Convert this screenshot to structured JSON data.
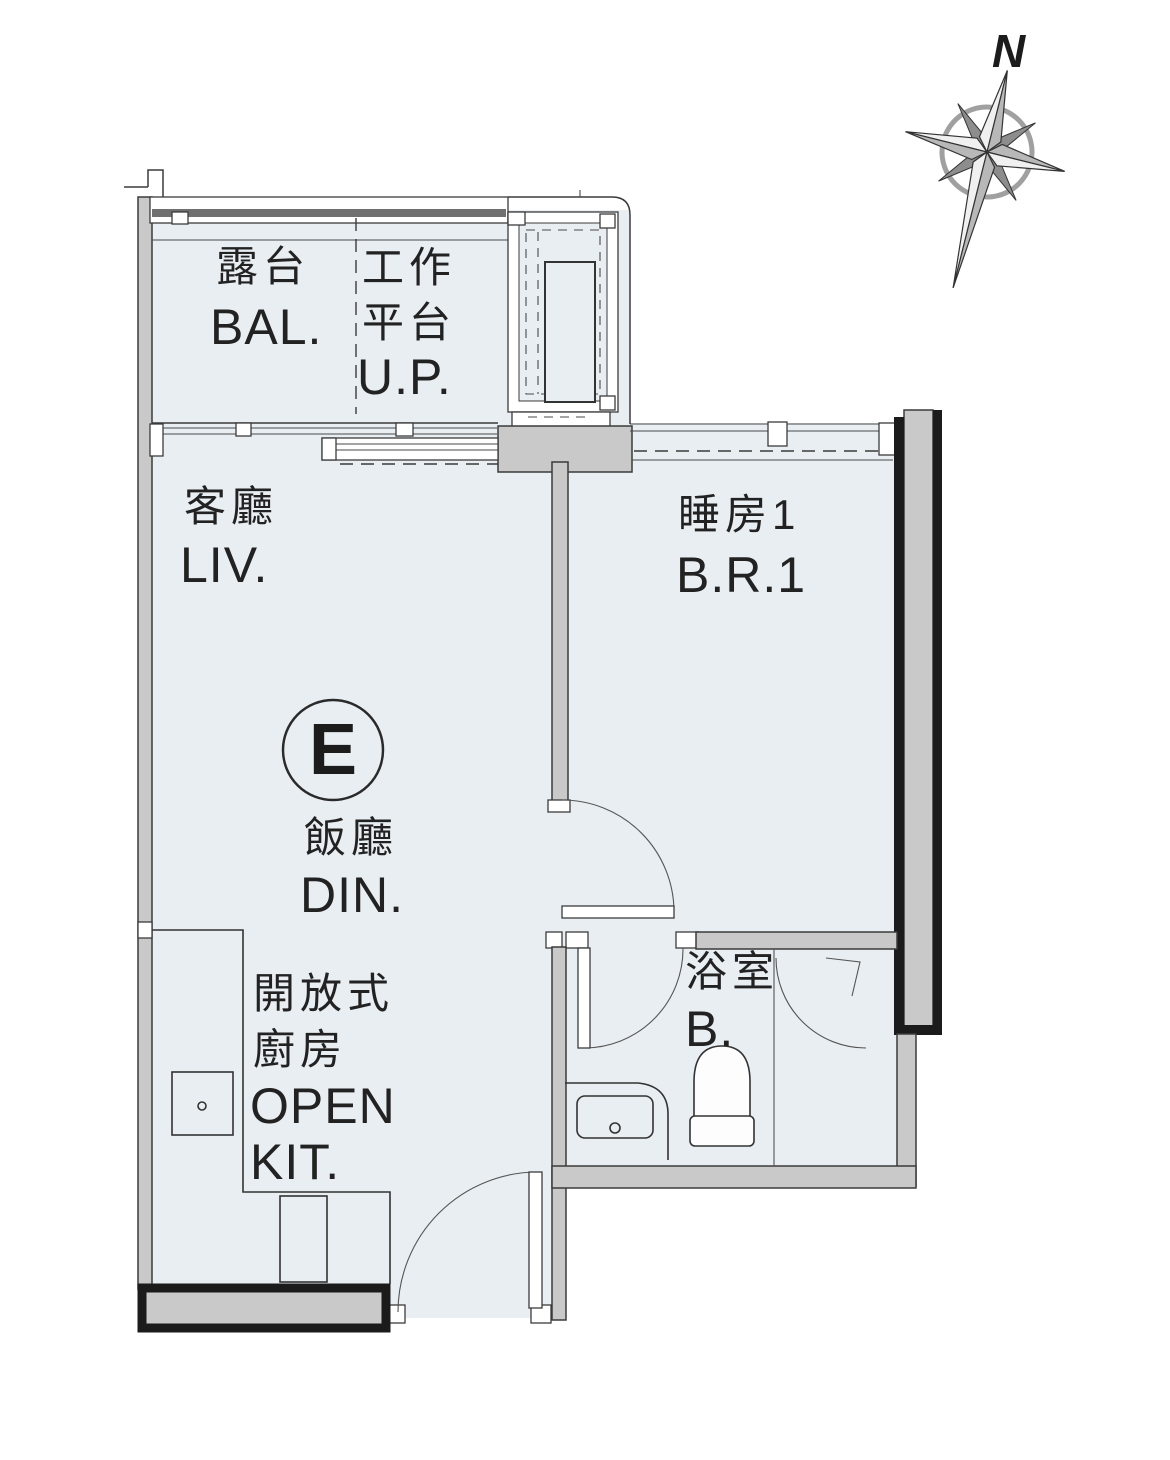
{
  "title": "Unit E floor plan",
  "compass": {
    "north_label": "N"
  },
  "unit": {
    "label": "E"
  },
  "rooms": {
    "balcony": {
      "zh": "露台",
      "en": "BAL."
    },
    "utility_platform": {
      "zh1": "工作",
      "zh2": "平台",
      "en": "U.P."
    },
    "living": {
      "zh": "客廳",
      "en": "LIV."
    },
    "bedroom1": {
      "zh": "睡房1",
      "en": "B.R.1"
    },
    "dining": {
      "zh": "飯廳",
      "en": "DIN."
    },
    "open_kitchen": {
      "zh1": "開放式",
      "zh2": "廚房",
      "en1": "OPEN",
      "en2": "KIT."
    },
    "bathroom": {
      "zh": "浴室",
      "en": "B."
    }
  },
  "colors": {
    "floor": "#e8eef2",
    "wall_gray": "#c9c9c9",
    "wall_black": "#1b1b1b",
    "line": "#3b3b3b",
    "label": "#222222"
  }
}
